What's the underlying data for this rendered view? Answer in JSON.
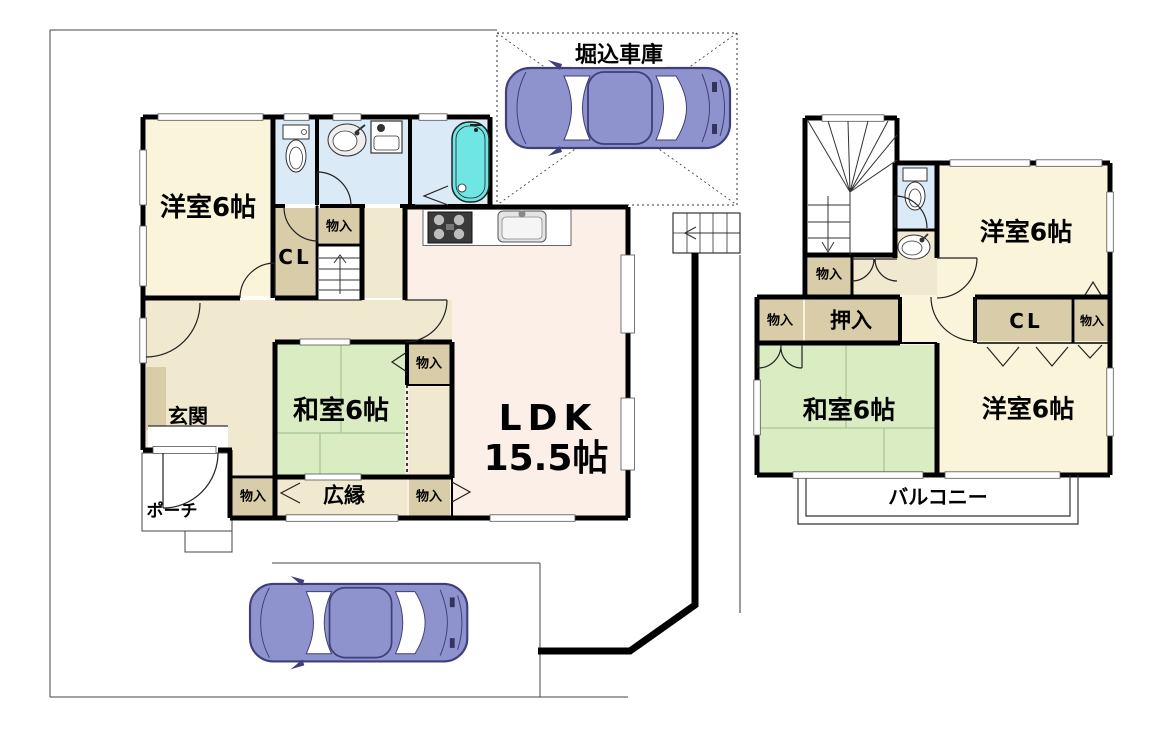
{
  "colors": {
    "wall": "#000000",
    "western_room_fill": "#faf4da",
    "japanese_room_fill": "#d9ecc2",
    "ldk_fill": "#fcefe7",
    "wet_area_fill": "#daeaf6",
    "closet_fill": "#d9cca9",
    "hall_fill": "#f0e9d0",
    "bathtub_fill": "#6fe6e3",
    "car_fill": "#8e93ce"
  },
  "floor1": {
    "garage_label": "堀込車庫",
    "western_room": "洋室6帖",
    "japanese_room": "和室6帖",
    "ldk_line1": "LDK",
    "ldk_line2": "15.5帖",
    "veranda": "広縁",
    "entrance": "玄関",
    "porch": "ポーチ",
    "closet": "CL",
    "storage_by_stairs": "物入",
    "storage_japanese_upper": "物入",
    "storage_japanese_lower": "物入",
    "storage_by_veranda": "物入"
  },
  "floor2": {
    "western_room_top": "洋室6帖",
    "western_room_bottom": "洋室6帖",
    "japanese_room": "和室6帖",
    "oshiire": "押入",
    "closet": "CL",
    "storage_under_stairs": "物入",
    "storage_left": "物入",
    "storage_right": "物入",
    "balcony": "バルコニー"
  }
}
